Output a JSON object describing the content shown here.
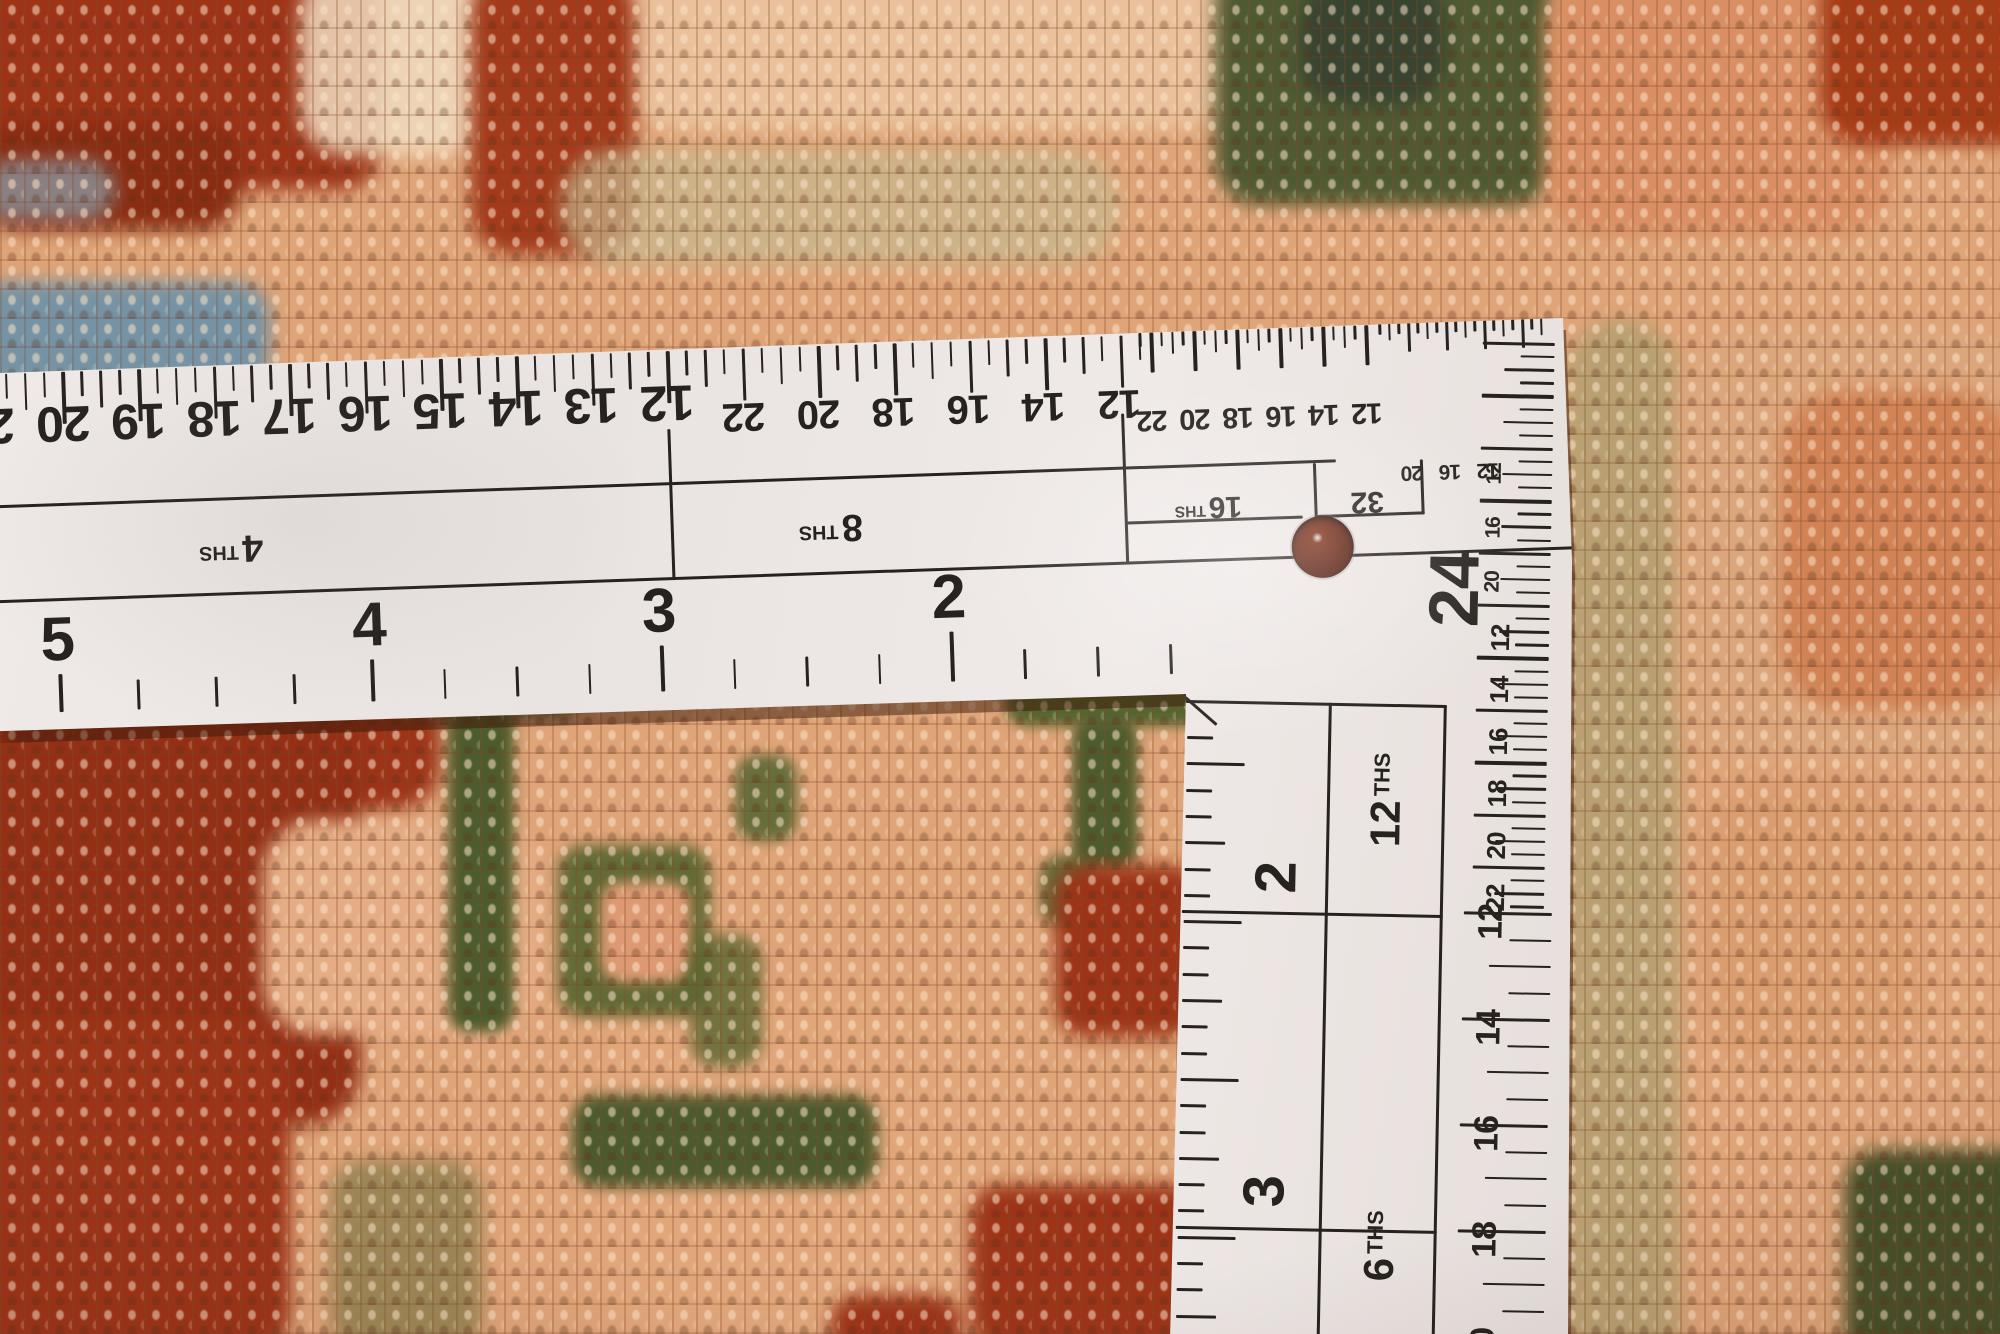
{
  "palette": {
    "carpet_base": "#dfa478",
    "knot_light": "#f6d9b8",
    "knot_dark": "#8a5430",
    "red": "#9d3418",
    "red_dark": "#8a2c12",
    "red_bright": "#b44a22",
    "green": "#57642f",
    "green_dark": "#39462e",
    "blue": "#7593a4",
    "sage": "#c6b98f",
    "salmon": "#d98f63",
    "cream": "#f1ddc1",
    "olive_tan": "#b3a071",
    "ruler_face": "#ebe6e3",
    "ruler_ink": "#26221e"
  },
  "square": {
    "top_scale": {
      "number_groups": [
        {
          "name": "inches-4ths",
          "font": 50,
          "y": 426,
          "rot": 180,
          "items": [
            [
              "21",
              -14
            ],
            [
              "20",
              62
            ],
            [
              "19",
              137
            ],
            [
              "18",
              213
            ],
            [
              "17",
              288
            ],
            [
              "16",
              364
            ],
            [
              "15",
              439
            ],
            [
              "14",
              515
            ],
            [
              "13",
              590
            ],
            [
              "12",
              666
            ]
          ]
        },
        {
          "name": "inches-8ths",
          "font": 40,
          "y": 442,
          "rot": 180,
          "items": [
            [
              "22",
              742
            ],
            [
              "20",
              817
            ],
            [
              "18",
              892
            ],
            [
              "16",
              967
            ],
            [
              "14",
              1042
            ],
            [
              "12",
              1118
            ]
          ]
        },
        {
          "name": "inches-16ths",
          "font": 29,
          "y": 459,
          "rot": 180,
          "items": [
            [
              "22",
              1150
            ],
            [
              "20",
              1193
            ],
            [
              "18",
              1236
            ],
            [
              "16",
              1279
            ],
            [
              "14",
              1322
            ],
            [
              "12",
              1365
            ]
          ]
        },
        {
          "name": "inches-32nds",
          "font": 21,
          "y": 521,
          "rot": 180,
          "items": [
            [
              "20",
              1408
            ],
            [
              "16",
              1446
            ],
            [
              "12",
              1484
            ]
          ]
        }
      ],
      "tick_zones": [
        {
          "start": -33.1,
          "step": 18.9,
          "count": 63,
          "phase": 1,
          "lens": [
            52,
            25,
            37,
            25
          ],
          "y": 374
        },
        {
          "start": 1139.3,
          "step": 10.75,
          "count": 22,
          "phase": 1,
          "lens": [
            40,
            14,
            22,
            14
          ],
          "y": 372
        },
        {
          "start": 1379.0,
          "step": 9.5,
          "count": 18,
          "phase": 3,
          "lens": [
            30,
            12,
            18,
            12
          ],
          "y": 370
        }
      ]
    },
    "mid_band": {
      "labels": [
        {
          "num": "4",
          "ths": "THS",
          "x": 225,
          "y": 556,
          "font": 38
        },
        {
          "num": "8",
          "ths": "THS",
          "x": 825,
          "y": 556,
          "font": 38
        },
        {
          "num": "16",
          "ths": "THS",
          "x": 1203,
          "y": 548,
          "font": 30
        },
        {
          "num": "32",
          "ths": "",
          "x": 1362,
          "y": 548,
          "font": 30
        }
      ]
    },
    "bottom_scale": {
      "font": 62,
      "numbers": [
        [
          "5",
          48,
          642
        ],
        [
          "4",
          360,
          638
        ],
        [
          "3",
          650,
          634
        ],
        [
          "2",
          940,
          630
        ]
      ],
      "extra_minor_x": [
        -25,
        1013,
        1086,
        1159
      ],
      "edge_y": 714
    },
    "hole": {
      "x": 1316,
      "y": 592,
      "r": 31
    },
    "v_arm": {
      "numbers_inner": {
        "font": 58,
        "rot": -90,
        "items": [
          [
            "2",
            1280,
            876
          ],
          [
            "3",
            1274,
            1190
          ]
        ]
      },
      "labels": [
        {
          "num": "12",
          "ths": "THS",
          "x": 1388,
          "y": 796,
          "font": 42
        },
        {
          "num": "6",
          "ths": "THS",
          "x": 1390,
          "y": 1242,
          "font": 42
        }
      ],
      "corner_number": {
        "num": "24",
        "x": 1452,
        "y": 584,
        "font": 70
      },
      "numbers_right": [
        {
          "font": 21,
          "x": 1490,
          "items": [
            [
              "12",
              468
            ],
            [
              "16",
              522
            ],
            [
              "20",
              576
            ]
          ]
        },
        {
          "font": 26,
          "x": 1499,
          "items": [
            [
              "12",
              632
            ],
            [
              "14",
              684
            ],
            [
              "16",
              736
            ],
            [
              "18",
              788
            ],
            [
              "20",
              840
            ],
            [
              "22",
              892
            ]
          ]
        },
        {
          "font": 34,
          "x": 1495,
          "items": [
            [
              "12",
              916
            ],
            [
              "14",
              1022
            ],
            [
              "16",
              1128
            ],
            [
              "18",
              1234
            ],
            [
              "20",
              1340
            ]
          ]
        }
      ],
      "inner_comb": {
        "x": 1188,
        "start": 736,
        "step": 26.3,
        "count": 23,
        "majors": [
          910,
          1226
        ]
      },
      "right_comb": [
        {
          "end_x": 1548,
          "start": 336,
          "to": 906,
          "step": 13.1,
          "lens": [
            72,
            34,
            50,
            34
          ]
        },
        {
          "end_x": 1556,
          "start": 906,
          "to": 1336,
          "step": 26.5,
          "lens": [
            88,
            42,
            62,
            42
          ]
        }
      ]
    }
  }
}
